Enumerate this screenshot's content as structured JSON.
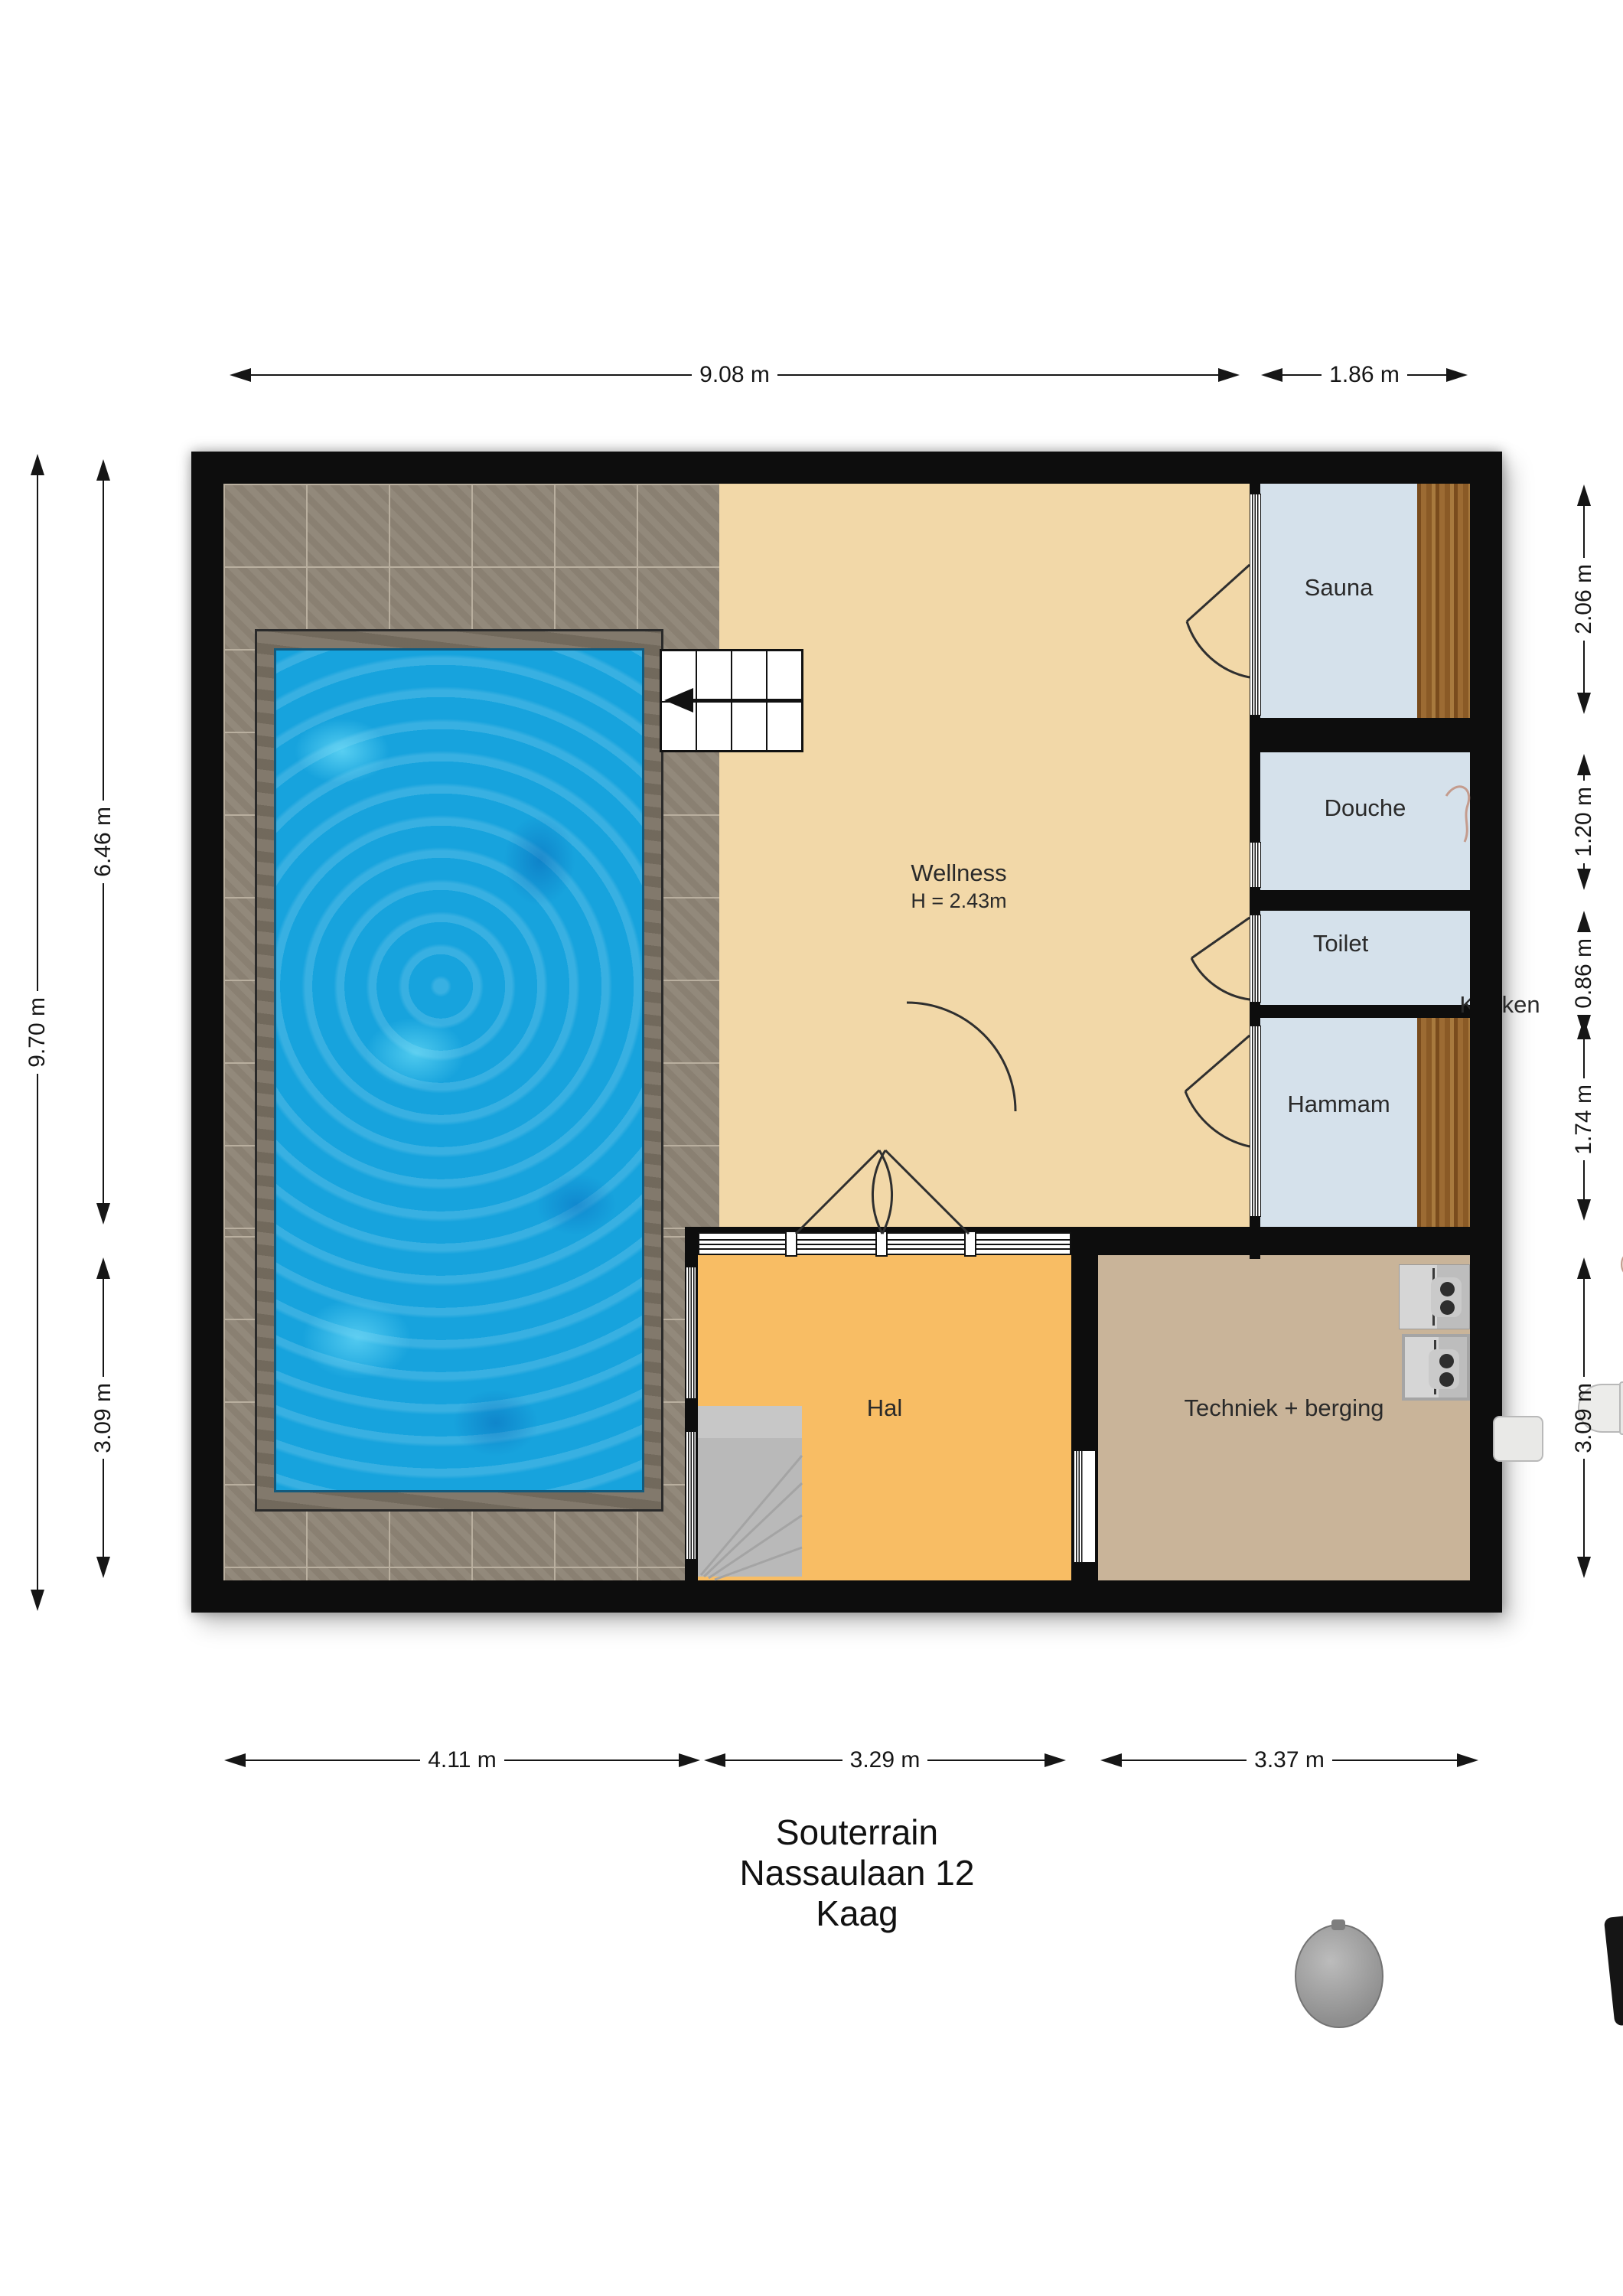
{
  "title": {
    "lines": [
      "Souterrain",
      "Nassaulaan 12",
      "Kaag"
    ]
  },
  "rooms": {
    "wellness": {
      "label": "Wellness",
      "height_note": "H = 2.43m"
    },
    "sauna": {
      "label": "Sauna"
    },
    "douche": {
      "label": "Douche"
    },
    "toilet": {
      "label": "Toilet"
    },
    "hammam": {
      "label": "Hammam"
    },
    "keuken": {
      "label": "Keuken"
    },
    "hal": {
      "label": "Hal"
    },
    "techniek": {
      "label": "Techniek + berging"
    }
  },
  "dimensions": {
    "top": [
      {
        "label": "9.08 m"
      },
      {
        "label": "1.86 m"
      }
    ],
    "left": [
      {
        "label": "9.70 m"
      },
      {
        "label": "6.46 m"
      },
      {
        "label": "3.09 m"
      }
    ],
    "right": [
      {
        "label": "2.06 m"
      },
      {
        "label": "1.20 m"
      },
      {
        "label": "0.86 m"
      },
      {
        "label": "1.74 m"
      },
      {
        "label": "3.09 m"
      }
    ],
    "bottom": [
      {
        "label": "4.11 m"
      },
      {
        "label": "3.29 m"
      },
      {
        "label": "3.37 m"
      }
    ]
  },
  "icons": [
    "stairs-up-icon",
    "stairs-down-icon",
    "shower-icon",
    "washing-machine-icon",
    "dryer-icon",
    "boiler-icon",
    "heat-pump-icon",
    "toilet-icon",
    "sink-icon"
  ],
  "colors": {
    "wall": "#0d0d0d",
    "pool_water": "#17a3dd",
    "pool_surround": "#7b7264",
    "tile_floor": "#8f8577",
    "wellness_floor": "#f2d8a8",
    "wet_room_floor": "#d5e1eb",
    "wood_bench": "#8a5a26",
    "hal_floor": "#f8bd64",
    "techniek_floor": "#c9b499",
    "stairs": "#b9b9b9"
  }
}
